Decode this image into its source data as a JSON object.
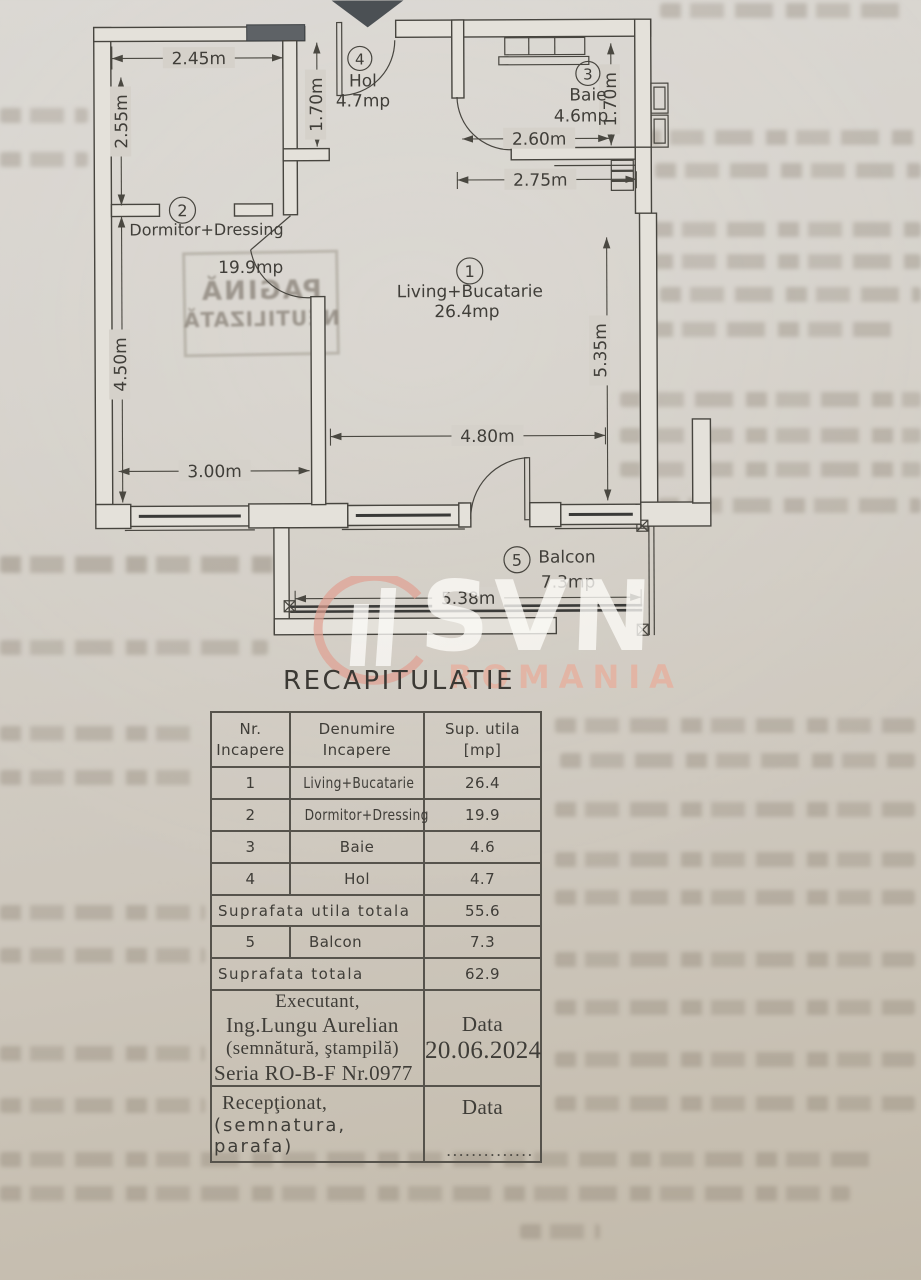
{
  "plan": {
    "rooms": [
      {
        "num": "1",
        "name": "Living+Bucatarie",
        "area": "26.4mp"
      },
      {
        "num": "2",
        "name": "Dormitor+Dressing",
        "area": "19.9mp"
      },
      {
        "num": "3",
        "name": "Baie",
        "area": "4.6mp"
      },
      {
        "num": "4",
        "name": "Hol",
        "area": "4.7mp"
      },
      {
        "num": "5",
        "name": "Balcon",
        "area": "7.3mp"
      }
    ],
    "dims": {
      "d245": "2.45m",
      "d255": "2.55m",
      "d170_hol": "1.70m",
      "d170_baie": "1.70m",
      "d260": "2.60m",
      "d275": "2.75m",
      "d450": "4.50m",
      "d535": "5.35m",
      "d480": "4.80m",
      "d300": "3.00m",
      "d538": "5.38m"
    }
  },
  "watermark": {
    "brand": "SVN",
    "country": "ROMANIA"
  },
  "bleed_stamp": {
    "line1": "PAGINĂ",
    "line2": "NEUTILIZATĂ"
  },
  "recap": {
    "title": "RECAPITULATIE",
    "header": {
      "c1a": "Nr.",
      "c1b": "Incapere",
      "c2a": "Denumire",
      "c2b": "Incapere",
      "c3a": "Sup. utila",
      "c3b": "[mp]"
    },
    "rows": [
      {
        "nr": "1",
        "name": "Living+Bucatarie",
        "area": "26.4"
      },
      {
        "nr": "2",
        "name": "Dormitor+Dressing",
        "area": "19.9"
      },
      {
        "nr": "3",
        "name": "Baie",
        "area": "4.6"
      },
      {
        "nr": "4",
        "name": "Hol",
        "area": "4.7"
      }
    ],
    "subtotal": {
      "label": "Suprafata utila totala",
      "value": "55.6"
    },
    "balcony": {
      "nr": "5",
      "name": "Balcon",
      "area": "7.3"
    },
    "total": {
      "label": "Suprafata totala",
      "value": "62.9"
    },
    "executant": {
      "l1": "Executant,",
      "l2": "Ing.Lungu Aurelian",
      "l3": "(semnătură, ştampilă)",
      "l4": "Seria RO-B-F Nr.0977",
      "data_label": "Data",
      "data_value": "20.06.2024"
    },
    "receptionat": {
      "l1": "Recepţionat,",
      "l2": "(semnatura, parafa)",
      "data_label": "Data",
      "dots": ".............."
    }
  }
}
